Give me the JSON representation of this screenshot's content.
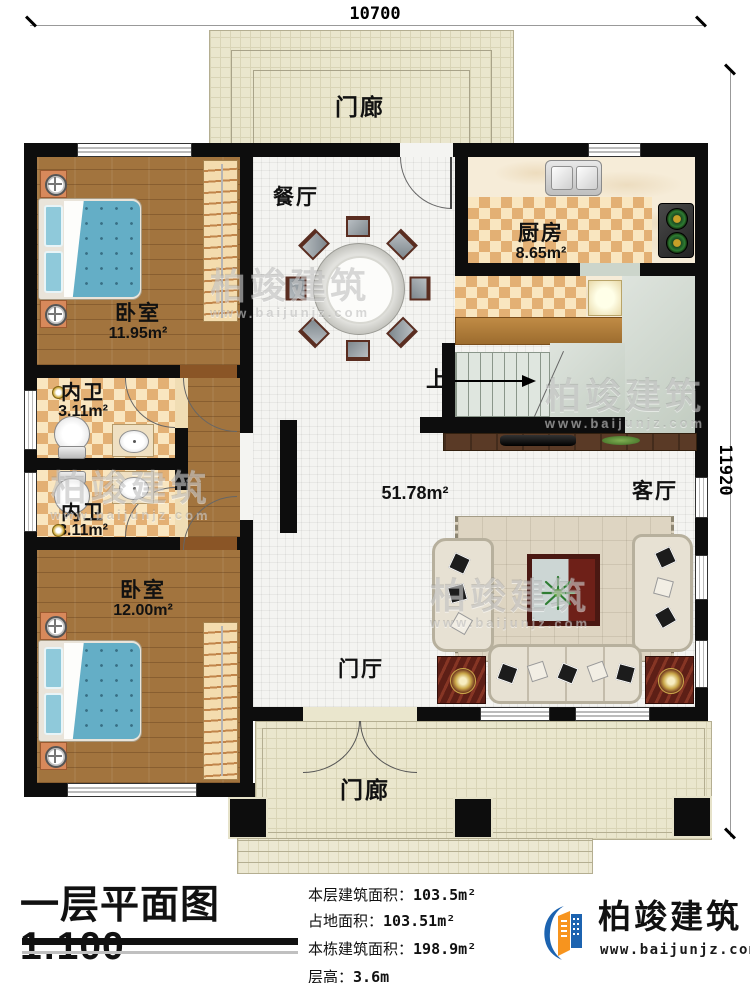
{
  "plan": {
    "scale_title": "一层平面图1:100",
    "dims": {
      "top": "10700",
      "right": "11920"
    }
  },
  "rooms": {
    "porch_top": {
      "label": "门廊"
    },
    "dining": {
      "label": "餐厅"
    },
    "kitchen": {
      "label": "厨房",
      "area": "8.65m²"
    },
    "bedroom1": {
      "label": "卧室",
      "area": "11.95m²"
    },
    "bath1": {
      "label": "内卫",
      "area": "3.11m²"
    },
    "bath2": {
      "label": "内卫",
      "area": "3.11m²"
    },
    "bedroom2": {
      "label": "卧室",
      "area": "12.00m²"
    },
    "living": {
      "label": "客厅"
    },
    "foyer": {
      "label": "门厅"
    },
    "porch_bottom": {
      "label": "门廊"
    },
    "open_area": {
      "area": "51.78m²"
    },
    "stairs": {
      "label": "上"
    }
  },
  "footer": {
    "title": "一层平面图1:100",
    "stats": [
      {
        "label": "本层建筑面积：",
        "value": "103.5m²"
      },
      {
        "label": "占地面积：",
        "value": "103.51m²"
      },
      {
        "label": "本栋建筑面积：",
        "value": "198.9m²"
      },
      {
        "label": "层高：",
        "value": "3.6m"
      }
    ],
    "logo": {
      "name": "柏竣建筑",
      "url": "www.baijunjz.com"
    }
  },
  "watermark": {
    "name": "柏竣建筑",
    "url": "www.baijunjz.com"
  },
  "colors": {
    "wall": "#0d0d0d",
    "accent_blue": "#1c63b0",
    "accent_orange": "#f7941e",
    "bed_blue": "#64aec6",
    "checker_light": "#f9e6c0",
    "checker_dark": "#e3b074",
    "wood": "#a2743e",
    "porch": "#eae6cd"
  }
}
